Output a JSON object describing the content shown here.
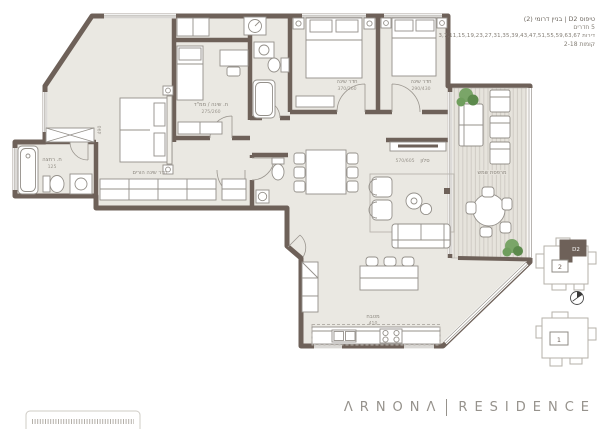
{
  "header": {
    "type_line": "טיפוס D2 | בניין דרומי (2)",
    "rooms_line": "5 חדרים",
    "units_line": "דירות 3,7,11,15,19,23,27,31,35,39,43,47,51,55,59,63,67",
    "floors_line": "קומות 2-18"
  },
  "plan": {
    "labels": {
      "master_bedroom": "חדר שינה הורים",
      "master_bedroom_dim": "490",
      "master_bath": "ח. רחצה",
      "master_bath_dim": "125",
      "bedroom_study": "ח. שינה / ממ\"ד",
      "bedroom_study_dim": "275/260",
      "bedroom_a": "חדר שינה",
      "bedroom_a_dim": "370/260",
      "bedroom_b": "חדר שינה",
      "bedroom_b_dim": "290/430",
      "living": "סלון",
      "living_dim": "570/605",
      "kitchen": "מטבח",
      "kitchen_dim": "410",
      "balcony": "מרפסת שמש"
    }
  },
  "keyplan": {
    "unit_tag": "D2",
    "building_top_label": "2",
    "building_bottom_label": "1"
  },
  "logo": {
    "brand": "ΛRNONΛ",
    "name": "RESIDENCE"
  },
  "colors": {
    "wall": "#6e6159",
    "floor": "#eae8e2",
    "deck": "#e6e3dc",
    "plant_green": "#6f9e5d",
    "logo_gray": "#96928c"
  }
}
